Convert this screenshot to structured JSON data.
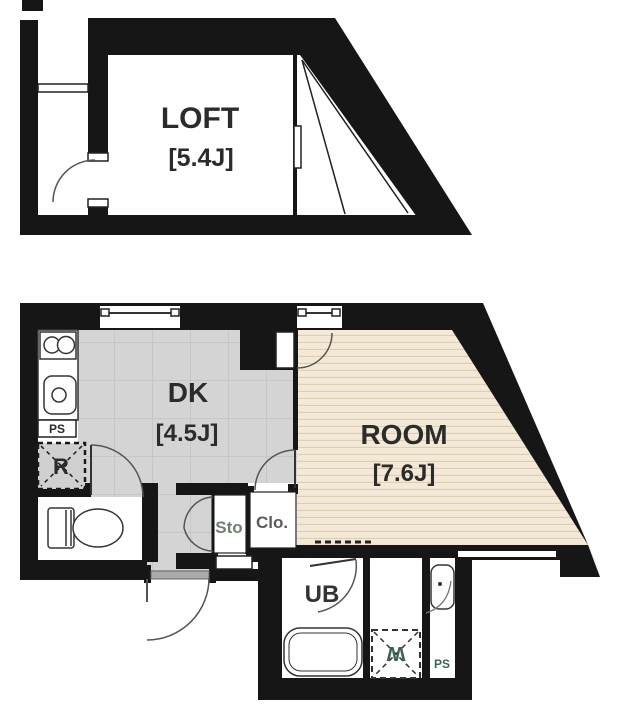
{
  "plan": {
    "upper": {
      "loft": {
        "label": "LOFT",
        "size": "[5.4J]"
      }
    },
    "lower": {
      "dk": {
        "label": "DK",
        "size": "[4.5J]"
      },
      "room": {
        "label": "ROOM",
        "size": "[7.6J]"
      },
      "labels": {
        "pipe_space_kitchen": "PS",
        "refrigerator": "R",
        "storage": "Sto",
        "closet": "Clo.",
        "unit_bath": "UB",
        "washing_machine": "W",
        "pipe_space_bath": "PS"
      }
    },
    "colors": {
      "wall": "#161616",
      "dk_floor": "#d4d4d4",
      "dk_grid": "#c2c2c2",
      "room_floor": "#f4e9d6",
      "room_stripe": "#dccfb6",
      "storage_text": "#6e8070",
      "closet_text": "#585d58",
      "washer_text": "#3f6357",
      "sill_gray": "#aaaaaa"
    }
  }
}
